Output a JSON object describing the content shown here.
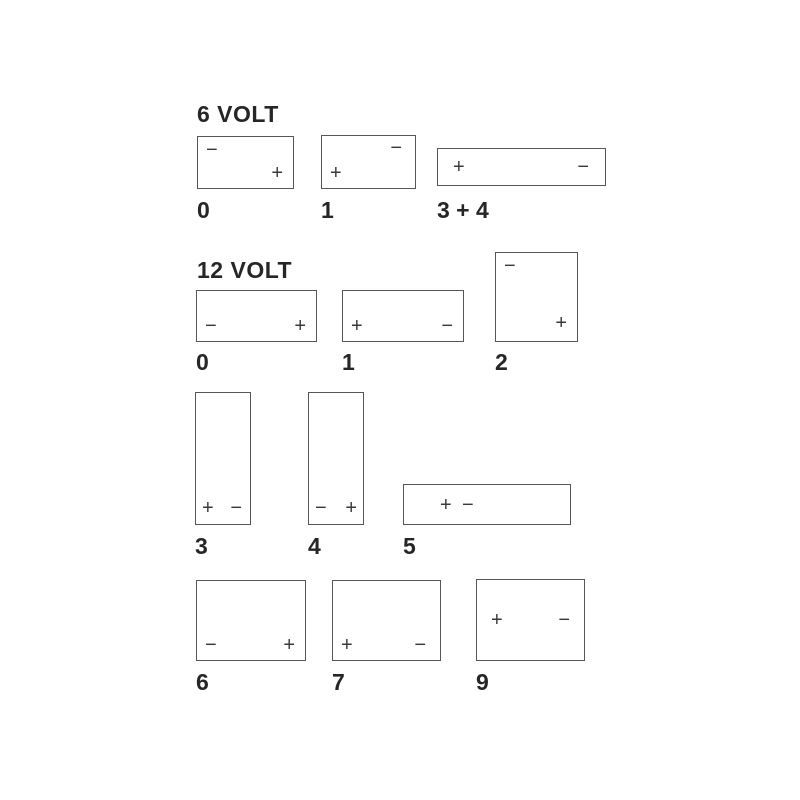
{
  "diagram": {
    "type": "battery-terminal-layout-chart",
    "background": "#ffffff",
    "border_color": "#565656",
    "sign_color": "#3a3a3a",
    "text_color": "#262626"
  },
  "sections": [
    {
      "title": "6 VOLT",
      "batteries": [
        {
          "label": "0",
          "shape": "landscape",
          "terminals": [
            {
              "sign": "−",
              "name": "negative",
              "position": "top-left"
            },
            {
              "sign": "+",
              "name": "positive",
              "position": "bottom-right"
            }
          ]
        },
        {
          "label": "1",
          "shape": "landscape",
          "terminals": [
            {
              "sign": "−",
              "name": "negative",
              "position": "top-right"
            },
            {
              "sign": "+",
              "name": "positive",
              "position": "bottom-left"
            }
          ]
        },
        {
          "label": "3 + 4",
          "shape": "wide-low",
          "terminals": [
            {
              "sign": "+",
              "name": "positive",
              "position": "middle-left"
            },
            {
              "sign": "−",
              "name": "negative",
              "position": "middle-right"
            }
          ]
        }
      ]
    },
    {
      "title": "12 VOLT",
      "batteries": [
        {
          "label": "0",
          "shape": "landscape",
          "terminals": [
            {
              "sign": "−",
              "name": "negative",
              "position": "bottom-left"
            },
            {
              "sign": "+",
              "name": "positive",
              "position": "bottom-right"
            }
          ]
        },
        {
          "label": "1",
          "shape": "landscape",
          "terminals": [
            {
              "sign": "+",
              "name": "positive",
              "position": "bottom-left"
            },
            {
              "sign": "−",
              "name": "negative",
              "position": "bottom-right"
            }
          ]
        },
        {
          "label": "2",
          "shape": "tall-square",
          "terminals": [
            {
              "sign": "−",
              "name": "negative",
              "position": "top-left"
            },
            {
              "sign": "+",
              "name": "positive",
              "position": "bottom-right"
            }
          ]
        },
        {
          "label": "3",
          "shape": "tall-narrow",
          "terminals": [
            {
              "sign": "+",
              "name": "positive",
              "position": "bottom-left"
            },
            {
              "sign": "−",
              "name": "negative",
              "position": "bottom-right"
            }
          ]
        },
        {
          "label": "4",
          "shape": "tall-narrow",
          "terminals": [
            {
              "sign": "−",
              "name": "negative",
              "position": "bottom-left"
            },
            {
              "sign": "+",
              "name": "positive",
              "position": "bottom-right"
            }
          ]
        },
        {
          "label": "5",
          "shape": "wide-low",
          "terminals": [
            {
              "sign": "+",
              "name": "positive",
              "position": "center-left"
            },
            {
              "sign": "−",
              "name": "negative",
              "position": "center-left-adjacent"
            }
          ]
        },
        {
          "label": "6",
          "shape": "landscape",
          "terminals": [
            {
              "sign": "−",
              "name": "negative",
              "position": "bottom-left"
            },
            {
              "sign": "+",
              "name": "positive",
              "position": "bottom-right"
            }
          ]
        },
        {
          "label": "7",
          "shape": "landscape",
          "terminals": [
            {
              "sign": "+",
              "name": "positive",
              "position": "bottom-left"
            },
            {
              "sign": "−",
              "name": "negative",
              "position": "bottom-right"
            }
          ]
        },
        {
          "label": "9",
          "shape": "landscape",
          "terminals": [
            {
              "sign": "+",
              "name": "positive",
              "position": "middle-left"
            },
            {
              "sign": "−",
              "name": "negative",
              "position": "middle-right"
            }
          ]
        }
      ]
    }
  ]
}
